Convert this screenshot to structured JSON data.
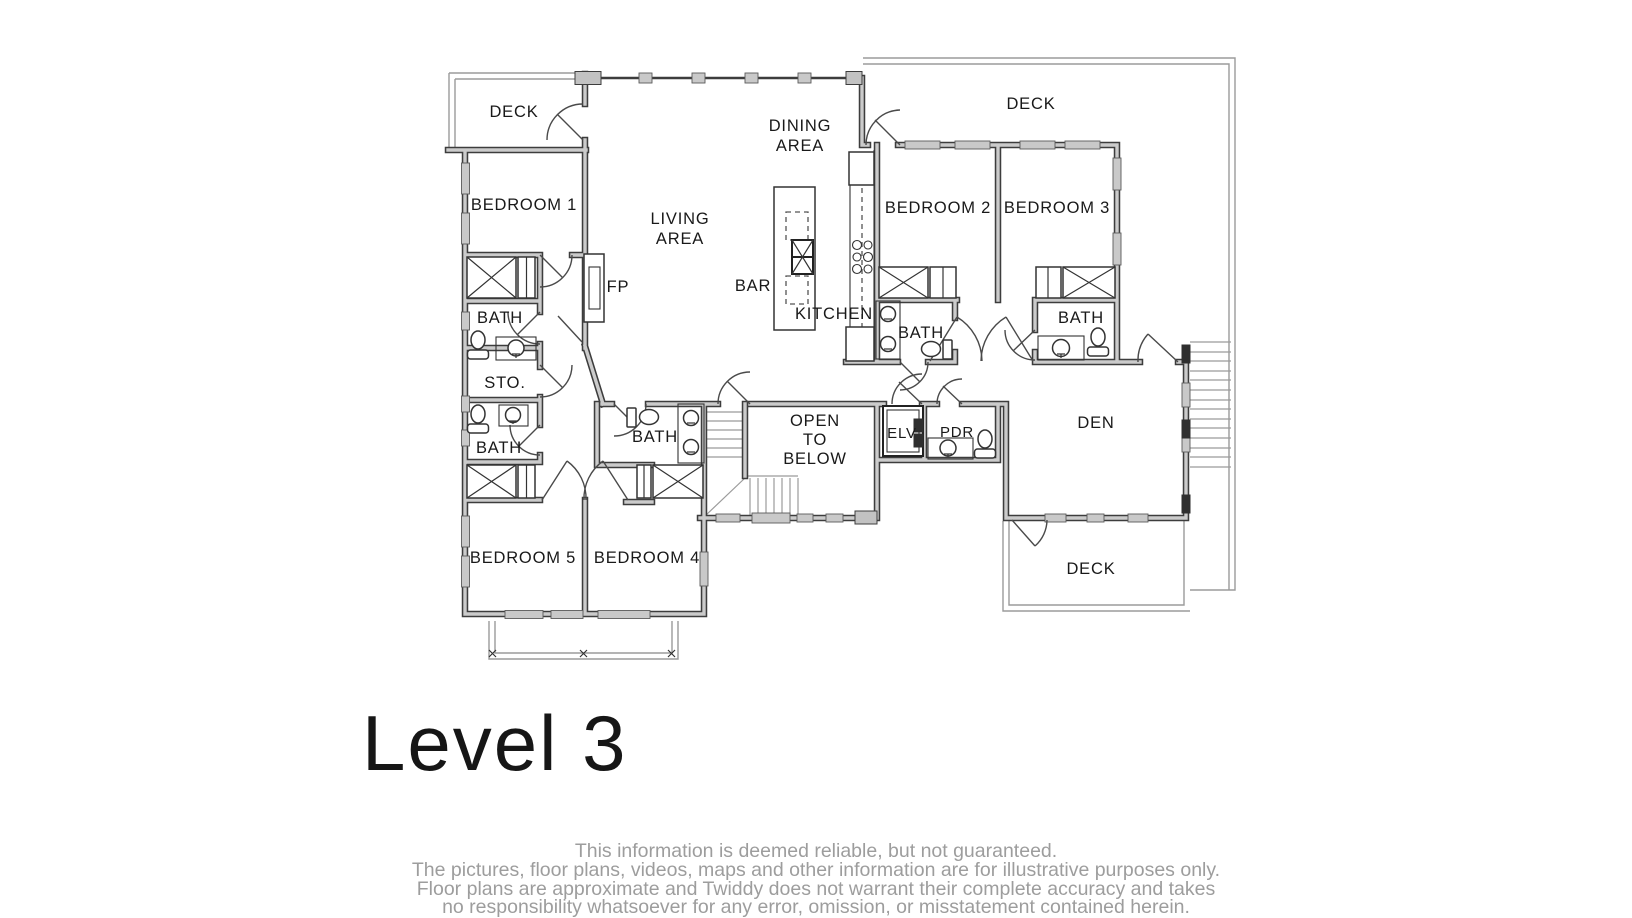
{
  "title": "Level 3",
  "plan": {
    "rooms": {
      "deck_top_left": {
        "label": "DECK"
      },
      "bedroom_1": {
        "label": "BEDROOM 1"
      },
      "bath_1": {
        "label": "BATH"
      },
      "storage": {
        "label": "STO."
      },
      "bath_2": {
        "label": "BATH"
      },
      "bedroom_5": {
        "label": "BEDROOM 5"
      },
      "bedroom_4": {
        "label": "BEDROOM 4"
      },
      "bath_3": {
        "label": "BATH"
      },
      "living_area": {
        "line1": "LIVING",
        "line2": "AREA"
      },
      "dining_area": {
        "line1": "DINING",
        "line2": "AREA"
      },
      "bar": {
        "label": "BAR"
      },
      "kitchen": {
        "label": "KITCHEN"
      },
      "fireplace": {
        "label": "FP"
      },
      "bedroom_2": {
        "label": "BEDROOM 2"
      },
      "bedroom_3": {
        "label": "BEDROOM 3"
      },
      "bath_bedroom_2": {
        "label": "BATH"
      },
      "bath_bedroom_3": {
        "label": "BATH"
      },
      "deck_top_right": {
        "label": "DECK"
      },
      "open_to_below": {
        "line1": "OPEN",
        "line2": "TO",
        "line3": "BELOW"
      },
      "elevator": {
        "label": "ELV"
      },
      "powder_room": {
        "label": "PDR"
      },
      "den": {
        "label": "DEN"
      },
      "deck_bottom_right": {
        "label": "DECK"
      }
    }
  },
  "disclaimer": {
    "lines": [
      "This information is deemed reliable, but not guaranteed.",
      "The pictures, floor plans, videos, maps and other information are for illustrative purposes only.",
      "Floor plans are approximate and Twiddy does not warrant their complete accuracy and takes",
      "no responsibility whatsoever for any error, omission, or misstatement contained herein."
    ]
  },
  "colors": {
    "background": "#ffffff",
    "wall_outline": "#3d3d3d",
    "wall_fill": "#cbcbcb",
    "thin_line": "#9b9b9b",
    "label_text": "#191919",
    "title_text": "#161616",
    "disclaimer_text": "#9d9d9d"
  }
}
